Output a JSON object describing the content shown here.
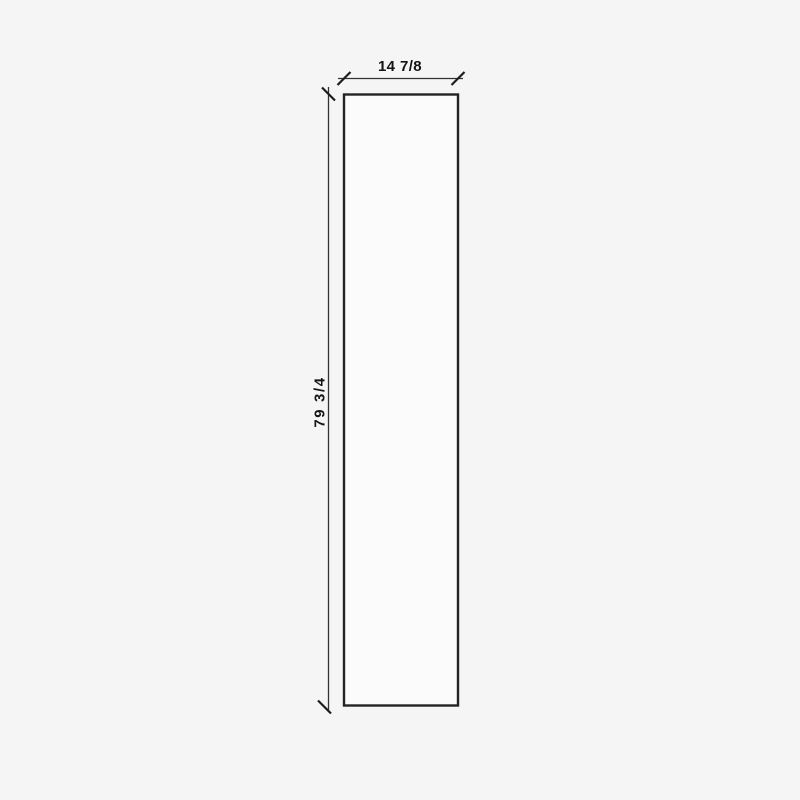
{
  "drawing": {
    "type": "dimensioned-panel-elevation",
    "width_dimension": {
      "label": "14 7/8"
    },
    "height_dimension": {
      "label": "79 3/4"
    }
  },
  "colors": {
    "background": "#f5f5f5",
    "panel_fill": "#fbfbfb",
    "outline": "#232323",
    "dimension_line": "#333333",
    "tick": "#1d1d1d",
    "text": "#141414"
  }
}
